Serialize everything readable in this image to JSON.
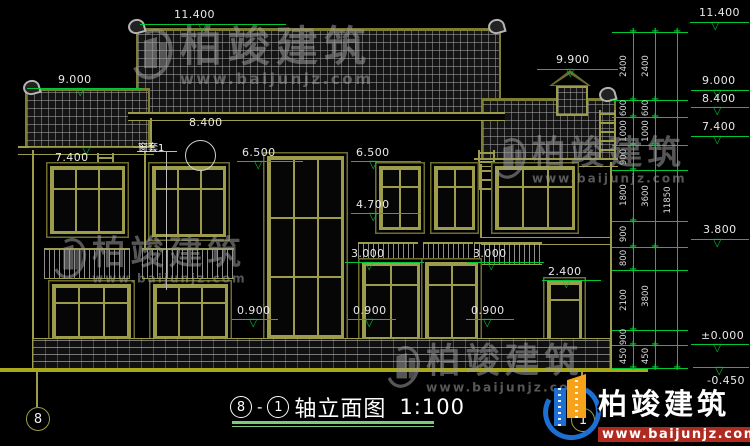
{
  "canvas": {
    "width": 750,
    "height": 446,
    "background": "#000000"
  },
  "colors": {
    "cad_green": "#00c832",
    "cad_olive": "#9c9c4a",
    "text": "#e8e8e8",
    "ground_line": "#a8a818",
    "logo_blue": "#1d6fd1",
    "logo_orange": "#f7a21b",
    "logo_url_red": "#b02a20"
  },
  "watermark": {
    "cjk": "柏竣建筑",
    "url": "www.baijunjz.com"
  },
  "brand_logo": {
    "cjk": "柏竣建筑",
    "url": "www.baijunjz.com"
  },
  "title_block": {
    "axis_a": "8",
    "separator": "-",
    "axis_b": "1",
    "name": "轴立面图",
    "scale": "1:100"
  },
  "axis_bubbles": [
    {
      "label": "8",
      "cx": 37,
      "cy": 418
    },
    {
      "label": "1",
      "cx": 582,
      "cy": 419
    }
  ],
  "detail_callout": {
    "elevation": "8.400",
    "label": "窗套1"
  },
  "elevations": [
    {
      "label": "11.400",
      "tx": 174,
      "ty": 8,
      "lx1": 140,
      "lx2": 286,
      "ly": 24,
      "trix": 204
    },
    {
      "label": "9.000",
      "tx": 58,
      "ty": 73,
      "lx1": 27,
      "lx2": 142,
      "ly": 88,
      "trix": 82
    },
    {
      "label": "9.900",
      "tx": 556,
      "ty": 53,
      "lx1": 537,
      "lx2": 618,
      "ly": 69,
      "trix": 572
    },
    {
      "label": "7.400",
      "tx": 55,
      "ty": 151,
      "lx1": 29,
      "lx2": 133,
      "ly": 147,
      "trix": 88
    },
    {
      "label": "6.500",
      "tx": 242,
      "ty": 146,
      "lx1": 237,
      "lx2": 303,
      "ly": 161,
      "trix": 260
    },
    {
      "label": "6.500",
      "tx": 356,
      "ty": 146,
      "lx1": 351,
      "lx2": 421,
      "ly": 161,
      "trix": 375
    },
    {
      "label": "4.700",
      "tx": 356,
      "ty": 198,
      "lx1": 351,
      "lx2": 421,
      "ly": 213,
      "trix": 375
    },
    {
      "label": "3.000",
      "tx": 351,
      "ty": 247,
      "lx1": 345,
      "lx2": 424,
      "ly": 262,
      "trix": 371
    },
    {
      "label": "3.000",
      "tx": 473,
      "ty": 247,
      "lx1": 467,
      "lx2": 544,
      "ly": 262,
      "trix": 493
    },
    {
      "label": "2.400",
      "tx": 548,
      "ty": 265,
      "lx1": 542,
      "lx2": 601,
      "ly": 280,
      "trix": 568
    },
    {
      "label": "0.900",
      "tx": 237,
      "ty": 304,
      "lx1": 232,
      "lx2": 278,
      "ly": 319,
      "trix": 255
    },
    {
      "label": "0.900",
      "tx": 353,
      "ty": 304,
      "lx1": 348,
      "lx2": 396,
      "ly": 319,
      "trix": 371
    },
    {
      "label": "0.900",
      "tx": 471,
      "ty": 304,
      "lx1": 466,
      "lx2": 514,
      "ly": 319,
      "trix": 489
    },
    {
      "label": "11.400",
      "tx": 699,
      "ty": 6,
      "lx1": 690,
      "lx2": 749,
      "ly": 22,
      "trix": 717
    },
    {
      "label": "9.000",
      "tx": 702,
      "ty": 74,
      "lx1": 691,
      "lx2": 749,
      "ly": 90,
      "trix": 719
    },
    {
      "label": "8.400",
      "tx": 702,
      "ty": 92,
      "lx1": 691,
      "lx2": 749,
      "ly": 107,
      "trix": 719
    },
    {
      "label": "7.400",
      "tx": 702,
      "ty": 120,
      "lx1": 691,
      "lx2": 749,
      "ly": 136,
      "trix": 719
    },
    {
      "label": "3.800",
      "tx": 703,
      "ty": 223,
      "lx1": 691,
      "lx2": 749,
      "ly": 239,
      "trix": 719
    },
    {
      "label": "±0.000",
      "tx": 701,
      "ty": 329,
      "lx1": 691,
      "lx2": 749,
      "ly": 344,
      "trix": 719
    },
    {
      "label": "-0.450",
      "tx": 707,
      "ty": 374,
      "lx1": 693,
      "lx2": 749,
      "ly": 367,
      "trix": 721
    }
  ],
  "dims": {
    "y_top": 32,
    "y_bottom": 368,
    "ext_x1": 612,
    "ext_x2": 688,
    "tick_ys": [
      32,
      100,
      117,
      145,
      170,
      221,
      247,
      270,
      330,
      345,
      368
    ],
    "total": "11850",
    "chains": [
      {
        "x": 633,
        "ticks": [
          32,
          100,
          117,
          145,
          170,
          221,
          247,
          270,
          330,
          345,
          368
        ],
        "segments": [
          {
            "label": "2400",
            "y": 66
          },
          {
            "label": "600",
            "y": 108
          },
          {
            "label": "1000",
            "y": 131
          },
          {
            "label": "900",
            "y": 157
          },
          {
            "label": "1800",
            "y": 195
          },
          {
            "label": "900",
            "y": 234
          },
          {
            "label": "800",
            "y": 258
          },
          {
            "label": "2100",
            "y": 300
          },
          {
            "label": "900",
            "y": 337
          },
          {
            "label": "450",
            "y": 356
          }
        ]
      },
      {
        "x": 655,
        "ticks": [
          32,
          100,
          117,
          145,
          247,
          345,
          368
        ],
        "segments": [
          {
            "label": "2400",
            "y": 66
          },
          {
            "label": "600",
            "y": 108
          },
          {
            "label": "1000",
            "y": 131
          },
          {
            "label": "3600",
            "y": 196
          },
          {
            "label": "3800",
            "y": 296
          },
          {
            "label": "450",
            "y": 356
          }
        ]
      },
      {
        "x": 677,
        "ticks": [
          32,
          368
        ],
        "segments": [
          {
            "label": "11850",
            "y": 200
          }
        ]
      }
    ]
  }
}
